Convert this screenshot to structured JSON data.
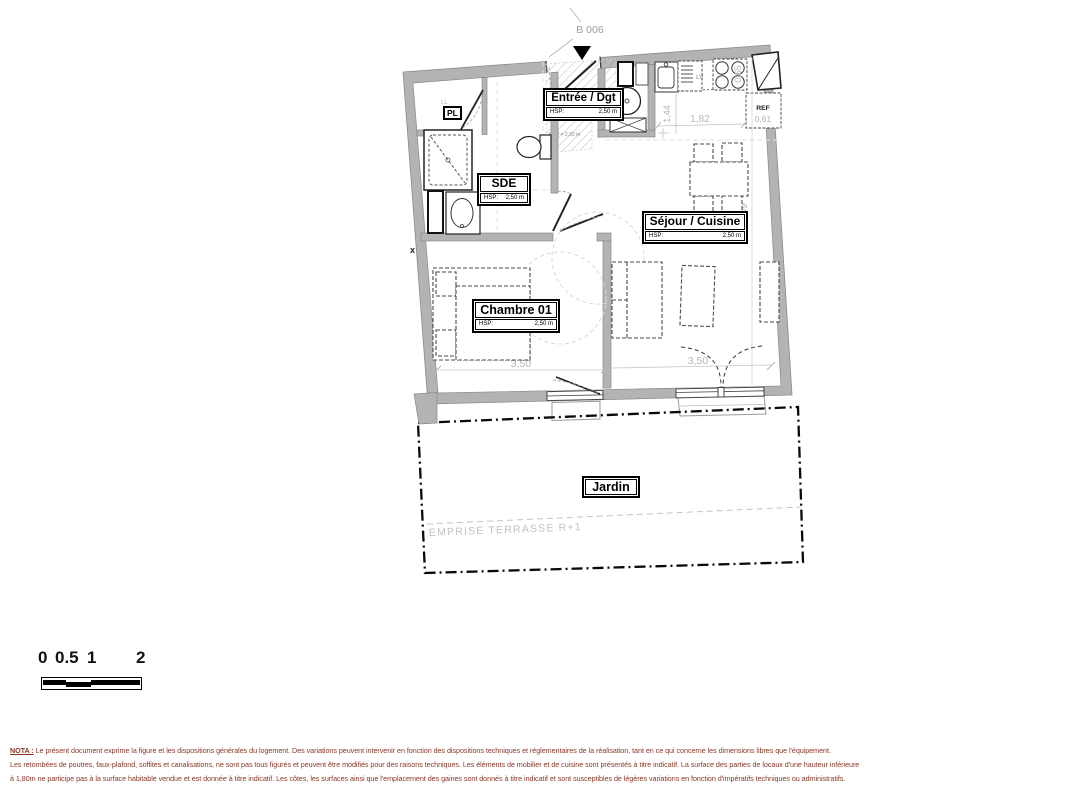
{
  "plan": {
    "entry_tag": "B 006",
    "rooms": {
      "entree": {
        "title": "Entrée / Dgt",
        "hsp_label": "HSP:",
        "hsp_value": "2,50 m"
      },
      "sde": {
        "title": "SDE",
        "hsp_label": "HSP:",
        "hsp_value": "2,50 m"
      },
      "sejour": {
        "title": "Séjour / Cuisine",
        "hsp_label": "HSP:",
        "hsp_value": "2,50 m"
      },
      "chambre": {
        "title": "Chambre 01",
        "hsp_label": "HSP:",
        "hsp_value": "2,50 m"
      },
      "jardin": {
        "title": "Jardin"
      }
    },
    "fixtures": {
      "pl": "PL",
      "ll": "LL",
      "lv": "LV",
      "ref": "REF"
    },
    "annotations": {
      "low_ceiling": "HSP = 2,30 m",
      "terrace": "EMPRISE TERRASSE R+1",
      "axis_mark": "x"
    },
    "dimensions": {
      "kitchen_width": "1,82",
      "kitchen_depth": "1,44",
      "counter_depth": "0,65",
      "fridge_width": "0,61",
      "sejour_height": "6,09",
      "chambre_width": "3,50",
      "sejour_width": "3,50"
    }
  },
  "scale_bar": {
    "labels": [
      "0",
      "0.5",
      "1",
      "2"
    ]
  },
  "nota": {
    "heading": "NOTA :",
    "line1_rest": " Le présent document exprime la figure et les dispositions générales du logement. Des variations peuvent intervenir en fonction des dispositions techniques et réglementaires de la réalisation, tant en ce qui concerne les dimensions libres que l'équipement.",
    "line2": "Les retombées de poutres, faux-plafond, soffites et canalisations, ne sont pas tous figurés et peuvent être modifiés pour des raisons techniques. Les éléments de mobilier et de cuisine sont présentés à titre indicatif. La surface des parties de locaux d'une hauteur inférieure",
    "line3": "à 1,80m ne participe pas à la surface habitable vendue et est donnée à titre indicatif. Les côtes, les surfaces ainsi que l'emplacement des gaines sont donnés à titre indicatif et sont susceptibles de légères variations en fonction d'impératifs techniques ou administratifs."
  }
}
